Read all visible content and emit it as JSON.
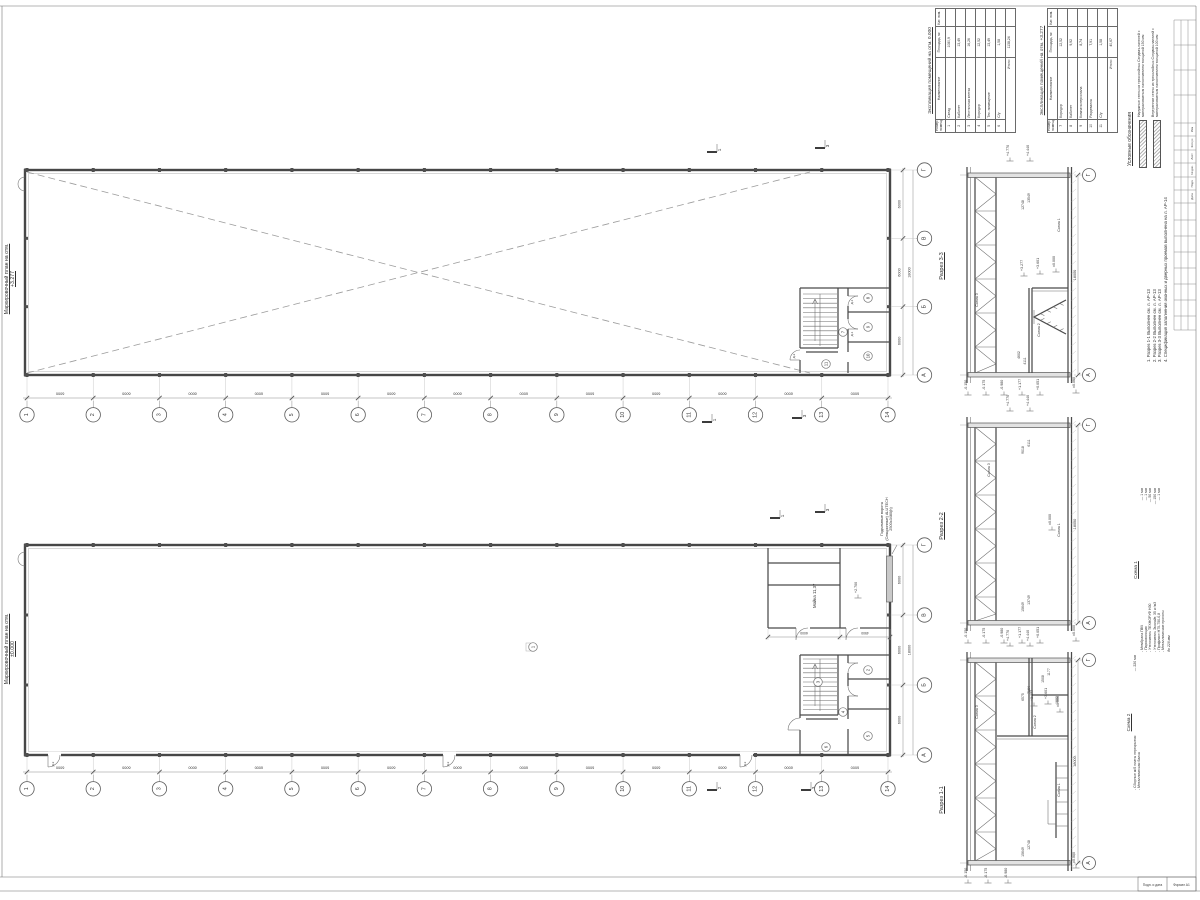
{
  "titles": {
    "plan_top_1": "Маркировочный план на отм.",
    "plan_top_2": "+3.277",
    "plan_bottom_1": "Маркировочный план на отм.",
    "plan_bottom_2": "±0.000",
    "section_3": "Разрез 3-3",
    "section_2": "Разрез 2-2",
    "section_1": "Разрез 1-1"
  },
  "tables": [
    {
      "title": "Экспликация помещений на отм. 0.000",
      "columns": [
        "Номер помещ.",
        "Наименование",
        "Площадь, м²",
        "Кат. пом."
      ],
      "rows": [
        [
          "1",
          "Склад",
          "1080,9",
          ""
        ],
        [
          "2",
          "Кабинет",
          "13,49",
          ""
        ],
        [
          "3",
          "Лестничная клетка",
          "16,26",
          ""
        ],
        [
          "4",
          "Коридор",
          "12,52",
          ""
        ],
        [
          "5",
          "Тех. помещение",
          "13,49",
          ""
        ],
        [
          "6",
          "С/у",
          "1,58",
          ""
        ]
      ],
      "total_label": "Итого:",
      "total_value": "1138,24"
    },
    {
      "title": "Экспликация помещений на отм. +3.277",
      "columns": [
        "Номер помещ.",
        "Наименование",
        "Площадь, м²",
        "Кат. пом."
      ],
      "rows": [
        [
          "7",
          "Коридор",
          "12,52",
          ""
        ],
        [
          "8",
          "Кабинет",
          "9,92",
          ""
        ],
        [
          "9",
          "Комната персонала",
          "8,74",
          ""
        ],
        [
          "10",
          "Раздевалка",
          "7,91",
          ""
        ],
        [
          "11",
          "С/у",
          "1,58",
          ""
        ]
      ],
      "total_label": "Итого:",
      "total_value": "40,67"
    }
  ],
  "legend": {
    "title": "Условные обозначения",
    "items": [
      "Наружные стены из трехслойных Сэндвич-панелей с минераловатным наполнителем толщиной 150 мм",
      "Внутренние стены из трехслойных Сэндвич-панелей с минераловатным наполнителем толщиной 100 мм"
    ]
  },
  "notes": [
    "1. Разрез 1-1 Выполнен см. л. АР-13",
    "2. Разрез 2-2 Выполнен см. л. АР-13",
    "3. Разрез 3-3 Выполнен см. л. АР-13",
    "4. Спецификация заполнения оконных и дверных проемов выполнена на л. АР-14"
  ],
  "scheme1": {
    "title": "Схема 1",
    "items": [
      [
        "Мембрана ПВХ",
        "1 мм"
      ],
      [
        "Пароизоляция",
        "1 мм"
      ],
      [
        "Утеплитель ТЕХНОРУФ Н30",
        "50 мм"
      ],
      [
        "Утеплитель Эколайт, 35 кг/м3",
        "150 мм"
      ],
      [
        "Профлист Н75-750-0,8",
        "1 мм"
      ],
      [
        "Металлические прогоны",
        ""
      ]
    ],
    "total": "до 228 мм"
  },
  "scheme2": {
    "title": "Схема 2",
    "items": [
      [
        "Сборные ж/б плиты перекрытия",
        "220 мм"
      ],
      [
        "Металлическая балка",
        ""
      ]
    ]
  },
  "gate_note": [
    "Подъемные ворота",
    "(Секционные) ALUTECH",
    "2500х3480(h)"
  ],
  "room_moyka": "Мойка 11,37",
  "axes": {
    "numbers": [
      "1",
      "2",
      "3",
      "4",
      "5",
      "6",
      "7",
      "8",
      "9",
      "10",
      "11",
      "12",
      "13",
      "14"
    ],
    "letters": [
      "Г",
      "В",
      "Б",
      "А"
    ],
    "bay": "6000",
    "overall": "18000"
  },
  "mezz_dims": [
    "6000",
    "4500"
  ],
  "levels": {
    "above": [
      "+4.770",
      "+4.440"
    ],
    "below": [
      "-0.150",
      "-0.175",
      "-0.980",
      "+1.177",
      "+0.051"
    ],
    "inner3": [
      "+3.277",
      "+3.601",
      "±0.000"
    ],
    "inner1": [
      "+3.277",
      "+3.601",
      "±0.000"
    ],
    "inner2": [
      "±0.000"
    ],
    "mezz": "+2.700",
    "zero": "±0.000"
  },
  "section_dims": {
    "s3_top": [
      "13549",
      "12748"
    ],
    "s3_bot": [
      "4602",
      "4111"
    ],
    "s2_top": [
      "6111",
      "9018"
    ],
    "s2_bot": [
      "13749",
      "15649"
    ],
    "s1_top": [
      "7164",
      "6575"
    ],
    "s1_top2": [
      "1177",
      "1508"
    ],
    "s1_mid": [
      "1082"
    ],
    "s1_bot": [
      "12748",
      "15649"
    ]
  },
  "schemes_tags": [
    "Схема 1",
    "Схема 2",
    "Схема 3"
  ],
  "room_tags_bottom": [
    "1",
    "2",
    "3",
    "4",
    "5",
    "6"
  ],
  "room_tags_top": [
    "7",
    "8",
    "9",
    "10",
    "11"
  ],
  "flags": {
    "f1": "1",
    "f2": "2",
    "f3": "3"
  },
  "door_tags": [
    "Д-1",
    "Д-2",
    "Д-3"
  ],
  "stamp": {
    "header": [
      "Изм",
      "Кол.уч",
      "Лист",
      "№ док.",
      "Подп.",
      "Дата"
    ],
    "corner_left": "Подп. и дата",
    "corner_right": "Формат А1"
  }
}
